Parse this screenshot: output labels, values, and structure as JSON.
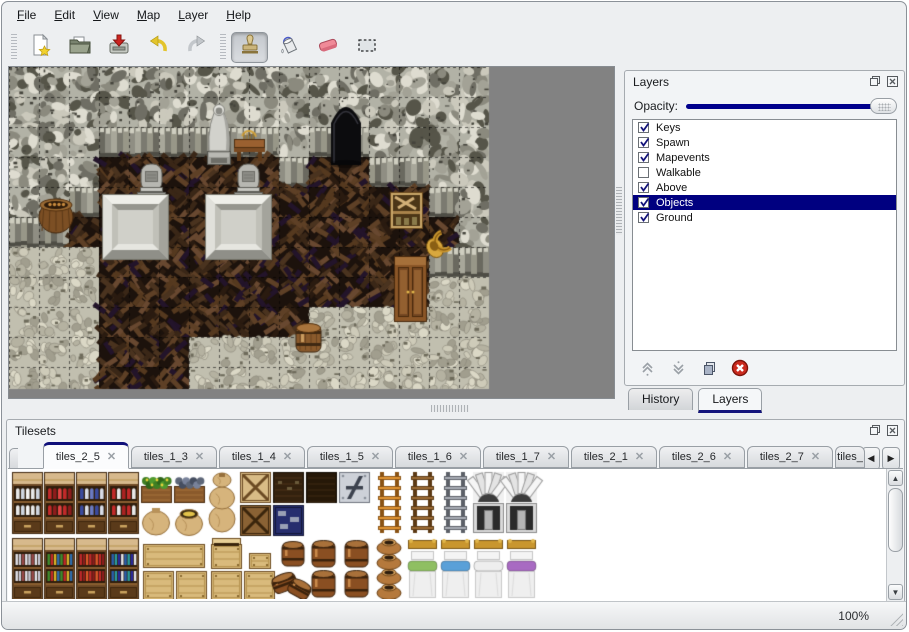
{
  "window": {
    "zoom": "100%"
  },
  "menu": {
    "items": [
      "File",
      "Edit",
      "View",
      "Map",
      "Layer",
      "Help"
    ]
  },
  "toolbar": {
    "buttons": [
      {
        "id": "new",
        "icon": "new-file-icon",
        "active": false
      },
      {
        "id": "open",
        "icon": "open-folder-icon",
        "active": false
      },
      {
        "id": "save",
        "icon": "save-icon",
        "active": false
      },
      {
        "id": "undo",
        "icon": "undo-icon",
        "active": false
      },
      {
        "id": "redo",
        "icon": "redo-icon",
        "active": false
      },
      {
        "id": "stamp",
        "icon": "stamp-tool-icon",
        "active": true
      },
      {
        "id": "fill",
        "icon": "fill-tool-icon",
        "active": false
      },
      {
        "id": "eraser",
        "icon": "eraser-tool-icon",
        "active": false
      },
      {
        "id": "select",
        "icon": "select-tool-icon",
        "active": false
      }
    ]
  },
  "layers_panel": {
    "title": "Layers",
    "opacity_label": "Opacity:",
    "opacity_percent": 100,
    "layers": [
      {
        "name": "Keys",
        "checked": true,
        "selected": false
      },
      {
        "name": "Spawn",
        "checked": true,
        "selected": false
      },
      {
        "name": "Mapevents",
        "checked": true,
        "selected": false
      },
      {
        "name": "Walkable",
        "checked": false,
        "selected": false
      },
      {
        "name": "Above",
        "checked": true,
        "selected": false
      },
      {
        "name": "Objects",
        "checked": true,
        "selected": true
      },
      {
        "name": "Ground",
        "checked": true,
        "selected": false
      }
    ],
    "tabs": [
      {
        "label": "History",
        "active": false
      },
      {
        "label": "Layers",
        "active": true
      }
    ]
  },
  "tilesets_panel": {
    "title": "Tilesets",
    "scroll_left": "◀",
    "scroll_right": "▶",
    "tabs": [
      {
        "label": "tiles_2_5",
        "active": true,
        "truncated": false
      },
      {
        "label": "tiles_1_3",
        "active": false,
        "truncated": false
      },
      {
        "label": "tiles_1_4",
        "active": false,
        "truncated": false
      },
      {
        "label": "tiles_1_5",
        "active": false,
        "truncated": false
      },
      {
        "label": "tiles_1_6",
        "active": false,
        "truncated": false
      },
      {
        "label": "tiles_1_7",
        "active": false,
        "truncated": false
      },
      {
        "label": "tiles_2_1",
        "active": false,
        "truncated": false
      },
      {
        "label": "tiles_2_6",
        "active": false,
        "truncated": false
      },
      {
        "label": "tiles_2_7",
        "active": false,
        "truncated": false
      },
      {
        "label": "tiles_",
        "active": false,
        "truncated": true
      }
    ]
  },
  "colors": {
    "selection": "#000080",
    "slider": "#00008c",
    "void": "#828282"
  },
  "map": {
    "tile": 30,
    "cols": 16,
    "rows": 11,
    "view_w": 605,
    "view_h": 331,
    "content_w": 480,
    "content_h": 322,
    "legend": {
      "W": "stone-wall",
      "F": "wood-floor",
      "R": "rubble-ground"
    },
    "grid": [
      "WWWWWWWWWWWWWWWW",
      "WWWWWWWWWWWWWWWW",
      "WWWWWWWWWWWWWWWW",
      "WWWFFFFFFWFFWWWW",
      "WWWFFFFFFFFFFFWW",
      "WWFFFFFFFFFFFFFW",
      "RRRFFFFFFFFFFFWW",
      "RRRFFFFFFFFFFFRR",
      "RRRFFFFFFFRRRRRR",
      "RRRFFFRRRRRRRRRR",
      "RRRFFFRRRRRRRRRR"
    ],
    "objects": [
      {
        "kind": "statue",
        "x": 193,
        "y": 34,
        "w": 34,
        "h": 66
      },
      {
        "kind": "table",
        "x": 224,
        "y": 64,
        "w": 34,
        "h": 32
      },
      {
        "kind": "door",
        "x": 318,
        "y": 30,
        "w": 38,
        "h": 68
      },
      {
        "kind": "grave",
        "x": 126,
        "y": 94,
        "w": 33,
        "h": 38
      },
      {
        "kind": "grave",
        "x": 223,
        "y": 94,
        "w": 33,
        "h": 38
      },
      {
        "kind": "altar",
        "x": 93,
        "y": 127,
        "w": 67,
        "h": 66
      },
      {
        "kind": "altar",
        "x": 196,
        "y": 127,
        "w": 67,
        "h": 66
      },
      {
        "kind": "basket",
        "x": 27,
        "y": 126,
        "w": 40,
        "h": 42
      },
      {
        "kind": "shelf",
        "x": 381,
        "y": 125,
        "w": 33,
        "h": 37
      },
      {
        "kind": "horn",
        "x": 417,
        "y": 159,
        "w": 31,
        "h": 33
      },
      {
        "kind": "wardrobe",
        "x": 385,
        "y": 189,
        "w": 33,
        "h": 66
      },
      {
        "kind": "barrel",
        "x": 284,
        "y": 254,
        "w": 31,
        "h": 33
      }
    ]
  },
  "tileset_tiles": {
    "tile": 31,
    "items": [
      {
        "k": "shelf",
        "x": 0,
        "y": 0,
        "p": [
          "#e8e8e8",
          "#cfd6e0",
          "#f4f4f4"
        ]
      },
      {
        "k": "shelf",
        "x": 32,
        "y": 0,
        "p": [
          "#c22a2a",
          "#8e1c1c",
          "#e04444"
        ]
      },
      {
        "k": "shelf",
        "x": 64,
        "y": 0,
        "p": [
          "#3a4a9e",
          "#d9dde8",
          "#6a7ac2"
        ]
      },
      {
        "k": "shelf",
        "x": 96,
        "y": 0,
        "p": [
          "#c22a2a",
          "#e8e8e8",
          "#aa2222"
        ]
      },
      {
        "k": "plantbox",
        "x": 129,
        "y": 0
      },
      {
        "k": "coalbox",
        "x": 162,
        "y": 0
      },
      {
        "k": "sackstack",
        "x": 195,
        "y": 0
      },
      {
        "k": "cratex",
        "x": 228,
        "y": 0,
        "p": [
          "#d9bc86",
          "#6b4a22"
        ]
      },
      {
        "k": "darkshelf",
        "x": 261,
        "y": 0
      },
      {
        "k": "darkcrate",
        "x": 294,
        "y": 0
      },
      {
        "k": "metal4",
        "x": 327,
        "y": 0
      },
      {
        "k": "ladder",
        "x": 362,
        "y": 0,
        "p": [
          "#e09434",
          "#8a5314"
        ]
      },
      {
        "k": "ladder",
        "x": 395,
        "y": 0,
        "p": [
          "#9a6a34",
          "#5c3a14"
        ]
      },
      {
        "k": "ladder",
        "x": 428,
        "y": 0,
        "p": [
          "#a9adb5",
          "#5c6068"
        ]
      },
      {
        "k": "stonedoor",
        "x": 461,
        "y": 0
      },
      {
        "k": "stonedoor",
        "x": 494,
        "y": 0
      },
      {
        "k": "sackfat",
        "x": 129,
        "y": 33
      },
      {
        "k": "sackopen",
        "x": 162,
        "y": 33
      },
      {
        "k": "cratex",
        "x": 228,
        "y": 33,
        "p": [
          "#8a6234",
          "#3a250c"
        ]
      },
      {
        "k": "navycrate",
        "x": 261,
        "y": 33
      },
      {
        "k": "bookshelf",
        "x": 0,
        "y": 66,
        "p": [
          "#e4e4ec",
          "#c9c9d6",
          "#9a4a4a"
        ]
      },
      {
        "k": "bookshelf",
        "x": 32,
        "y": 66,
        "p": [
          "#3f8f2e",
          "#c22a2a",
          "#d9b42a",
          "#2e6fb0"
        ]
      },
      {
        "k": "bookshelf",
        "x": 64,
        "y": 66,
        "p": [
          "#c22a2a",
          "#8e1c1c",
          "#e05a2a"
        ]
      },
      {
        "k": "bookshelf",
        "x": 96,
        "y": 66,
        "p": [
          "#2a5fb0",
          "#2a9e9e",
          "#2a2a9e",
          "#e8e8e8"
        ]
      },
      {
        "k": "cratelow",
        "x": 131,
        "y": 72
      },
      {
        "k": "crateopen",
        "x": 199,
        "y": 66
      },
      {
        "k": "cratesmall",
        "x": 237,
        "y": 81
      },
      {
        "k": "crate",
        "x": 131,
        "y": 99
      },
      {
        "k": "crate",
        "x": 164,
        "y": 99
      },
      {
        "k": "crate",
        "x": 199,
        "y": 99
      },
      {
        "k": "crate",
        "x": 232,
        "y": 99
      },
      {
        "k": "barrelcluster",
        "x": 258,
        "y": 68
      },
      {
        "k": "barrelstack",
        "x": 296,
        "y": 66
      },
      {
        "k": "barrelstack",
        "x": 329,
        "y": 66
      },
      {
        "k": "potstack",
        "x": 362,
        "y": 66
      },
      {
        "k": "bed",
        "x": 395,
        "y": 66,
        "p": "#8fbf62"
      },
      {
        "k": "bed",
        "x": 428,
        "y": 66,
        "p": "#5aa0d8"
      },
      {
        "k": "bed",
        "x": 461,
        "y": 66,
        "p": "#eeeeee"
      },
      {
        "k": "bed",
        "x": 494,
        "y": 66,
        "p": "#a86ac2"
      }
    ]
  }
}
